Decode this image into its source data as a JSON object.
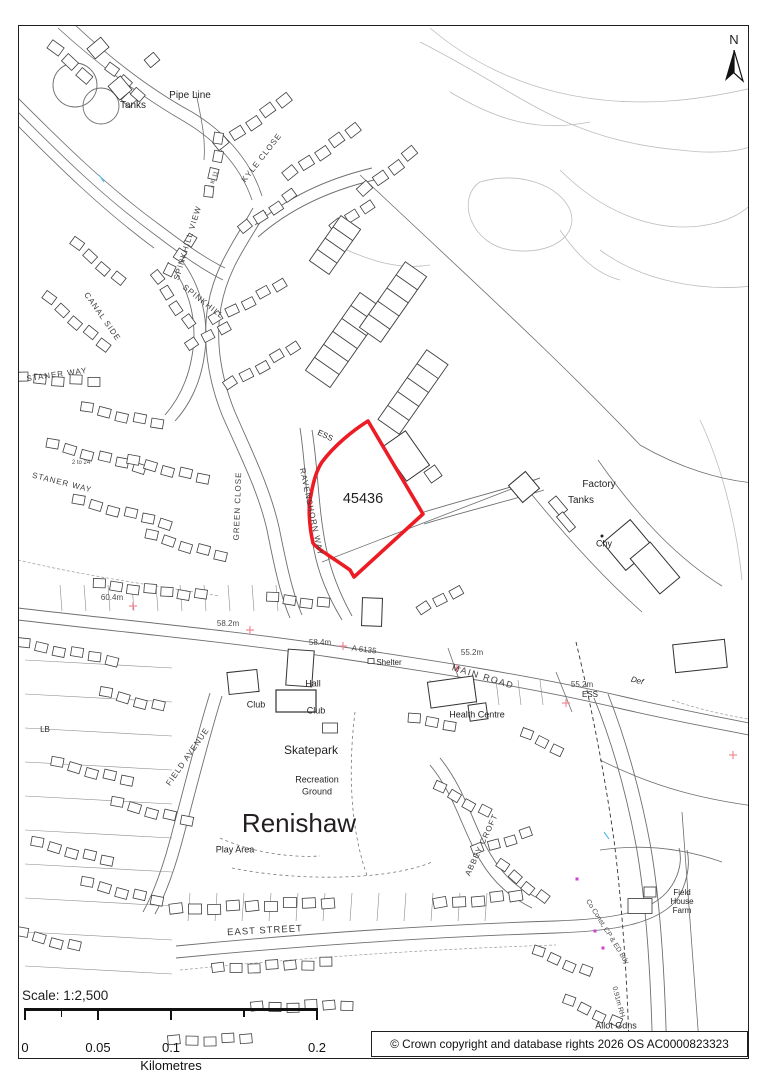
{
  "north": {
    "label": "N"
  },
  "plot": {
    "id": "45436",
    "outline_color": "#ec1c24"
  },
  "scalebar": {
    "title": "Scale: 1:2,500",
    "unit": "Kilometres",
    "ticks": [
      "0",
      "0.05",
      "0.1",
      "0.2"
    ]
  },
  "copyright": {
    "text": "© Crown copyright and database rights 2026 OS AC0000823323"
  },
  "colors": {
    "plot_outline": "#ec1c24",
    "benchmark": "#f08d96",
    "boundary_marker": "#cc44cc",
    "linework": "#4d4d4d"
  },
  "labels": [
    {
      "name": "label-tanks-nw",
      "text": "Tanks",
      "x": 133,
      "y": 106,
      "size": 10,
      "cls": "place"
    },
    {
      "name": "label-pipe-line",
      "text": "Pipe Line",
      "x": 190,
      "y": 96,
      "size": 10,
      "cls": "place"
    },
    {
      "name": "street-kyle-close",
      "text": "KYLE CLOSE",
      "x": 262,
      "y": 158,
      "size": 8,
      "rot": -52,
      "ls": 1,
      "cls": "street"
    },
    {
      "name": "label-1-to-11",
      "text": "1 to 11",
      "x": 214,
      "y": 180,
      "size": 6,
      "rot": -70,
      "cls": "small"
    },
    {
      "name": "street-spinkhill-view",
      "text": "SPINKHILL VIEW",
      "x": 188,
      "y": 243,
      "size": 8,
      "rot": -73,
      "ls": 1,
      "cls": "street"
    },
    {
      "name": "street-spinkhill",
      "text": "SPINKHILL",
      "x": 203,
      "y": 302,
      "size": 8,
      "rot": 38,
      "ls": 1,
      "cls": "street"
    },
    {
      "name": "street-canal-side",
      "text": "CANAL SIDE",
      "x": 102,
      "y": 317,
      "size": 8,
      "rot": 55,
      "ls": 1,
      "cls": "street"
    },
    {
      "name": "street-staner-way-n",
      "text": "STANER WAY",
      "x": 57,
      "y": 375,
      "size": 8,
      "rot": -8,
      "ls": 1,
      "cls": "street"
    },
    {
      "name": "street-staner-way-s",
      "text": "STANER WAY",
      "x": 62,
      "y": 483,
      "size": 8,
      "rot": 14,
      "ls": 1,
      "cls": "street"
    },
    {
      "name": "label-2-to-24",
      "text": "2 to 24",
      "x": 81,
      "y": 463,
      "size": 6,
      "cls": "small"
    },
    {
      "name": "street-green-close",
      "text": "GREEN CLOSE",
      "x": 238,
      "y": 506,
      "size": 8,
      "rot": -88,
      "ls": 1,
      "cls": "street"
    },
    {
      "name": "street-ravenshorn-way",
      "text": "RAVENSHORN WAY",
      "x": 311,
      "y": 512,
      "size": 8,
      "rot": 78,
      "ls": 1,
      "cls": "street"
    },
    {
      "name": "label-ess-plot",
      "text": "ESS",
      "x": 325,
      "y": 436,
      "size": 8,
      "rot": 25,
      "cls": "place"
    },
    {
      "name": "plot-number",
      "text": "45436",
      "x": 363,
      "y": 499,
      "size": 14.5,
      "cls": "place"
    },
    {
      "name": "label-factory",
      "text": "Factory",
      "x": 599,
      "y": 485,
      "size": 10,
      "cls": "place"
    },
    {
      "name": "label-tanks-e",
      "text": "Tanks",
      "x": 581,
      "y": 501,
      "size": 10,
      "cls": "place"
    },
    {
      "name": "label-chy",
      "text": "Chy",
      "x": 604,
      "y": 544,
      "size": 9,
      "cls": "place"
    },
    {
      "name": "benchmark-60-4",
      "text": "60.4m",
      "x": 112,
      "y": 598,
      "size": 8,
      "cls": "small"
    },
    {
      "name": "benchmark-58-2",
      "text": "58.2m",
      "x": 228,
      "y": 624,
      "size": 8,
      "cls": "small"
    },
    {
      "name": "benchmark-58-4",
      "text": "58.4m",
      "x": 320,
      "y": 643,
      "size": 8,
      "cls": "small"
    },
    {
      "name": "road-ref-a6135",
      "text": "A 6135",
      "x": 364,
      "y": 650,
      "size": 8,
      "rot": 7,
      "cls": "small"
    },
    {
      "name": "label-shelter",
      "text": "Shelter",
      "x": 389,
      "y": 663,
      "size": 8,
      "cls": "place"
    },
    {
      "name": "benchmark-55-2-w",
      "text": "55.2m",
      "x": 472,
      "y": 653,
      "size": 8,
      "cls": "small"
    },
    {
      "name": "street-main-road",
      "text": "MAIN ROAD",
      "x": 483,
      "y": 677,
      "size": 9,
      "rot": 17,
      "ls": 1.5,
      "cls": "street"
    },
    {
      "name": "label-health-centre",
      "text": "Health Centre",
      "x": 477,
      "y": 715,
      "size": 9,
      "cls": "place"
    },
    {
      "name": "benchmark-55-2-e",
      "text": "55.2m",
      "x": 582,
      "y": 685,
      "size": 8,
      "cls": "small"
    },
    {
      "name": "label-ess-e",
      "text": "ESS",
      "x": 590,
      "y": 695,
      "size": 8,
      "cls": "place"
    },
    {
      "name": "label-def",
      "text": "Def",
      "x": 637,
      "y": 681,
      "size": 8,
      "rot": 15,
      "cls": "italic"
    },
    {
      "name": "label-hall",
      "text": "Hall",
      "x": 313,
      "y": 684,
      "size": 9,
      "cls": "place"
    },
    {
      "name": "label-club-w",
      "text": "Club",
      "x": 256,
      "y": 705,
      "size": 9,
      "cls": "place"
    },
    {
      "name": "label-club-box",
      "text": "Club",
      "x": 316,
      "y": 711,
      "size": 9,
      "cls": "place"
    },
    {
      "name": "label-lb",
      "text": "LB",
      "x": 45,
      "y": 730,
      "size": 8,
      "cls": "place"
    },
    {
      "name": "label-skatepark",
      "text": "Skatepark",
      "x": 311,
      "y": 750,
      "size": 12,
      "cls": "place"
    },
    {
      "name": "label-recreation",
      "text": "Recreation",
      "x": 317,
      "y": 780,
      "size": 9,
      "cls": "place"
    },
    {
      "name": "label-ground",
      "text": "Ground",
      "x": 317,
      "y": 792,
      "size": 9,
      "cls": "place"
    },
    {
      "name": "label-renishaw",
      "text": "Renishaw",
      "x": 299,
      "y": 823,
      "size": 26,
      "cls": "place"
    },
    {
      "name": "label-play-area",
      "text": "Play Area",
      "x": 235,
      "y": 850,
      "size": 9,
      "cls": "place"
    },
    {
      "name": "street-field-avenue",
      "text": "FIELD  AVENUE",
      "x": 188,
      "y": 757,
      "size": 8,
      "rot": -55,
      "ls": 1,
      "cls": "street"
    },
    {
      "name": "street-east-street",
      "text": "EAST STREET",
      "x": 265,
      "y": 931,
      "size": 9.5,
      "rot": -3,
      "ls": 1,
      "cls": "street"
    },
    {
      "name": "street-abbey-croft",
      "text": "ABBEY  CROFT",
      "x": 482,
      "y": 845,
      "size": 8,
      "rot": -65,
      "ls": 1,
      "cls": "street"
    },
    {
      "name": "boundary-co-const",
      "text": "Co Const, CP & ED Bdy",
      "x": 607,
      "y": 932,
      "size": 7,
      "rot": 58,
      "cls": "small"
    },
    {
      "name": "boundary-091m-rh",
      "text": "0.91m RH",
      "x": 618,
      "y": 1002,
      "size": 7,
      "rot": 75,
      "cls": "small"
    },
    {
      "name": "label-field",
      "text": "Field",
      "x": 682,
      "y": 893,
      "size": 8,
      "cls": "place"
    },
    {
      "name": "label-house",
      "text": "House",
      "x": 682,
      "y": 902,
      "size": 8,
      "cls": "place"
    },
    {
      "name": "label-farm",
      "text": "Farm",
      "x": 682,
      "y": 911,
      "size": 8,
      "cls": "place"
    },
    {
      "name": "label-allot-gdns",
      "text": "Allot Gdns",
      "x": 616,
      "y": 1026,
      "size": 9,
      "cls": "place"
    }
  ]
}
